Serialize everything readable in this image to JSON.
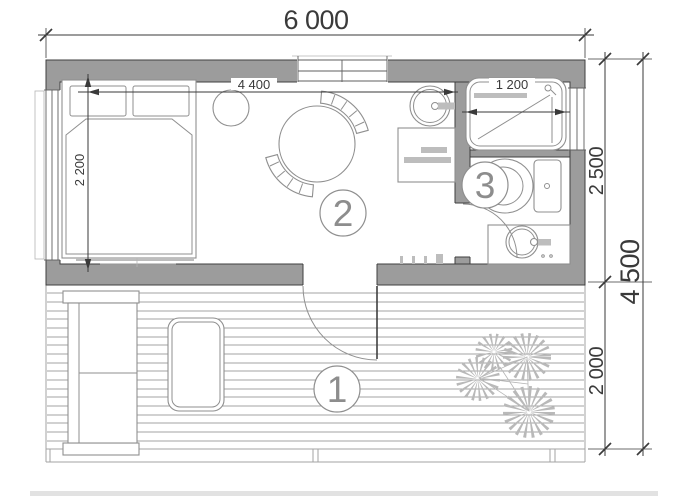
{
  "meta": {
    "title": "Cabin floor plan 6000 x 4500"
  },
  "colors": {
    "wall": "#9c9c9c",
    "wall_edge": "#3f3f3f",
    "line": "#8f8f8f",
    "line2": "#b5b5b5",
    "deck": "#a3a3a3",
    "dim": "#3a3a3a",
    "label": "#8d8d8d",
    "appliance": "#bdbdbd",
    "plant": "#b9b9b9"
  },
  "dimensions": {
    "overall_width": "6 000",
    "interior_width": "4 400",
    "bed_area_depth": "2 200",
    "shower_width": "1 200",
    "house_depth": "2 500",
    "terrace_depth": "2 000",
    "overall_depth": "4 500"
  },
  "room_labels": {
    "terrace": "1",
    "main_room": "2",
    "bathroom": "3"
  },
  "symbols": [
    "double-bed",
    "pillow",
    "bedside-table",
    "dining-table",
    "chair",
    "kitchen-sink",
    "kitchen-counter",
    "shower-tray",
    "toilet",
    "washbasin",
    "garden-sofa",
    "terrace-table",
    "plant",
    "door-swing",
    "window",
    "deck-boards"
  ]
}
